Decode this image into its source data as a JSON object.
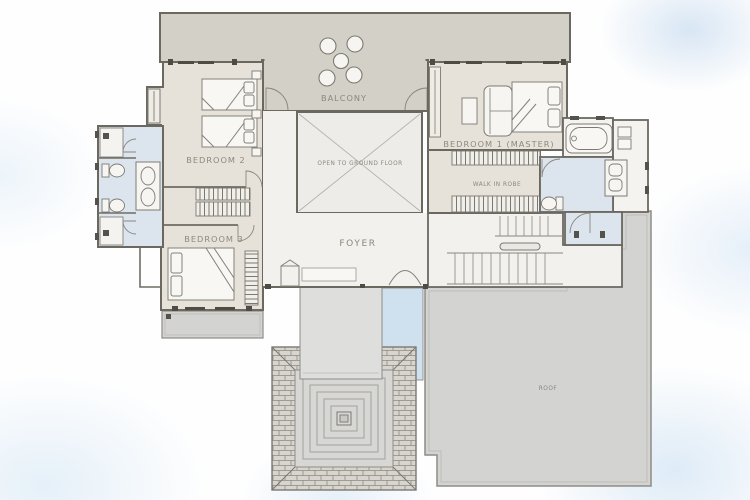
{
  "labels": {
    "balcony": "BALCONY",
    "bedroom2": "BEDROOM 2",
    "bedroom3": "BEDROOM 3",
    "bedroom1": "BEDROOM 1 (MASTER)",
    "open_to_ground_floor": "OPEN TO GROUND FLOOR",
    "walk_in_robe": "WALK IN ROBE",
    "foyer": "FOYER",
    "roof": "ROOF"
  },
  "colors": {
    "wall": "#6b6860",
    "wall_thin": "#85827a",
    "room_beige": "#e7e2d9",
    "terrace": "#d3d0c8",
    "void_fill": "#edece8",
    "foyer_fill": "#f2f1ed",
    "wet_area_blue": "#dce5ee",
    "water_strip_blue": "#cfe1ee",
    "roof_gray": "#d3d3d1",
    "porch_gray": "#dededc",
    "paving_brick": "#d8d5cf",
    "label_text": "#8b887e",
    "fixture_white": "#f6f5f2",
    "window_mark": "#55524b",
    "background_wash": "#d7e6f4"
  }
}
